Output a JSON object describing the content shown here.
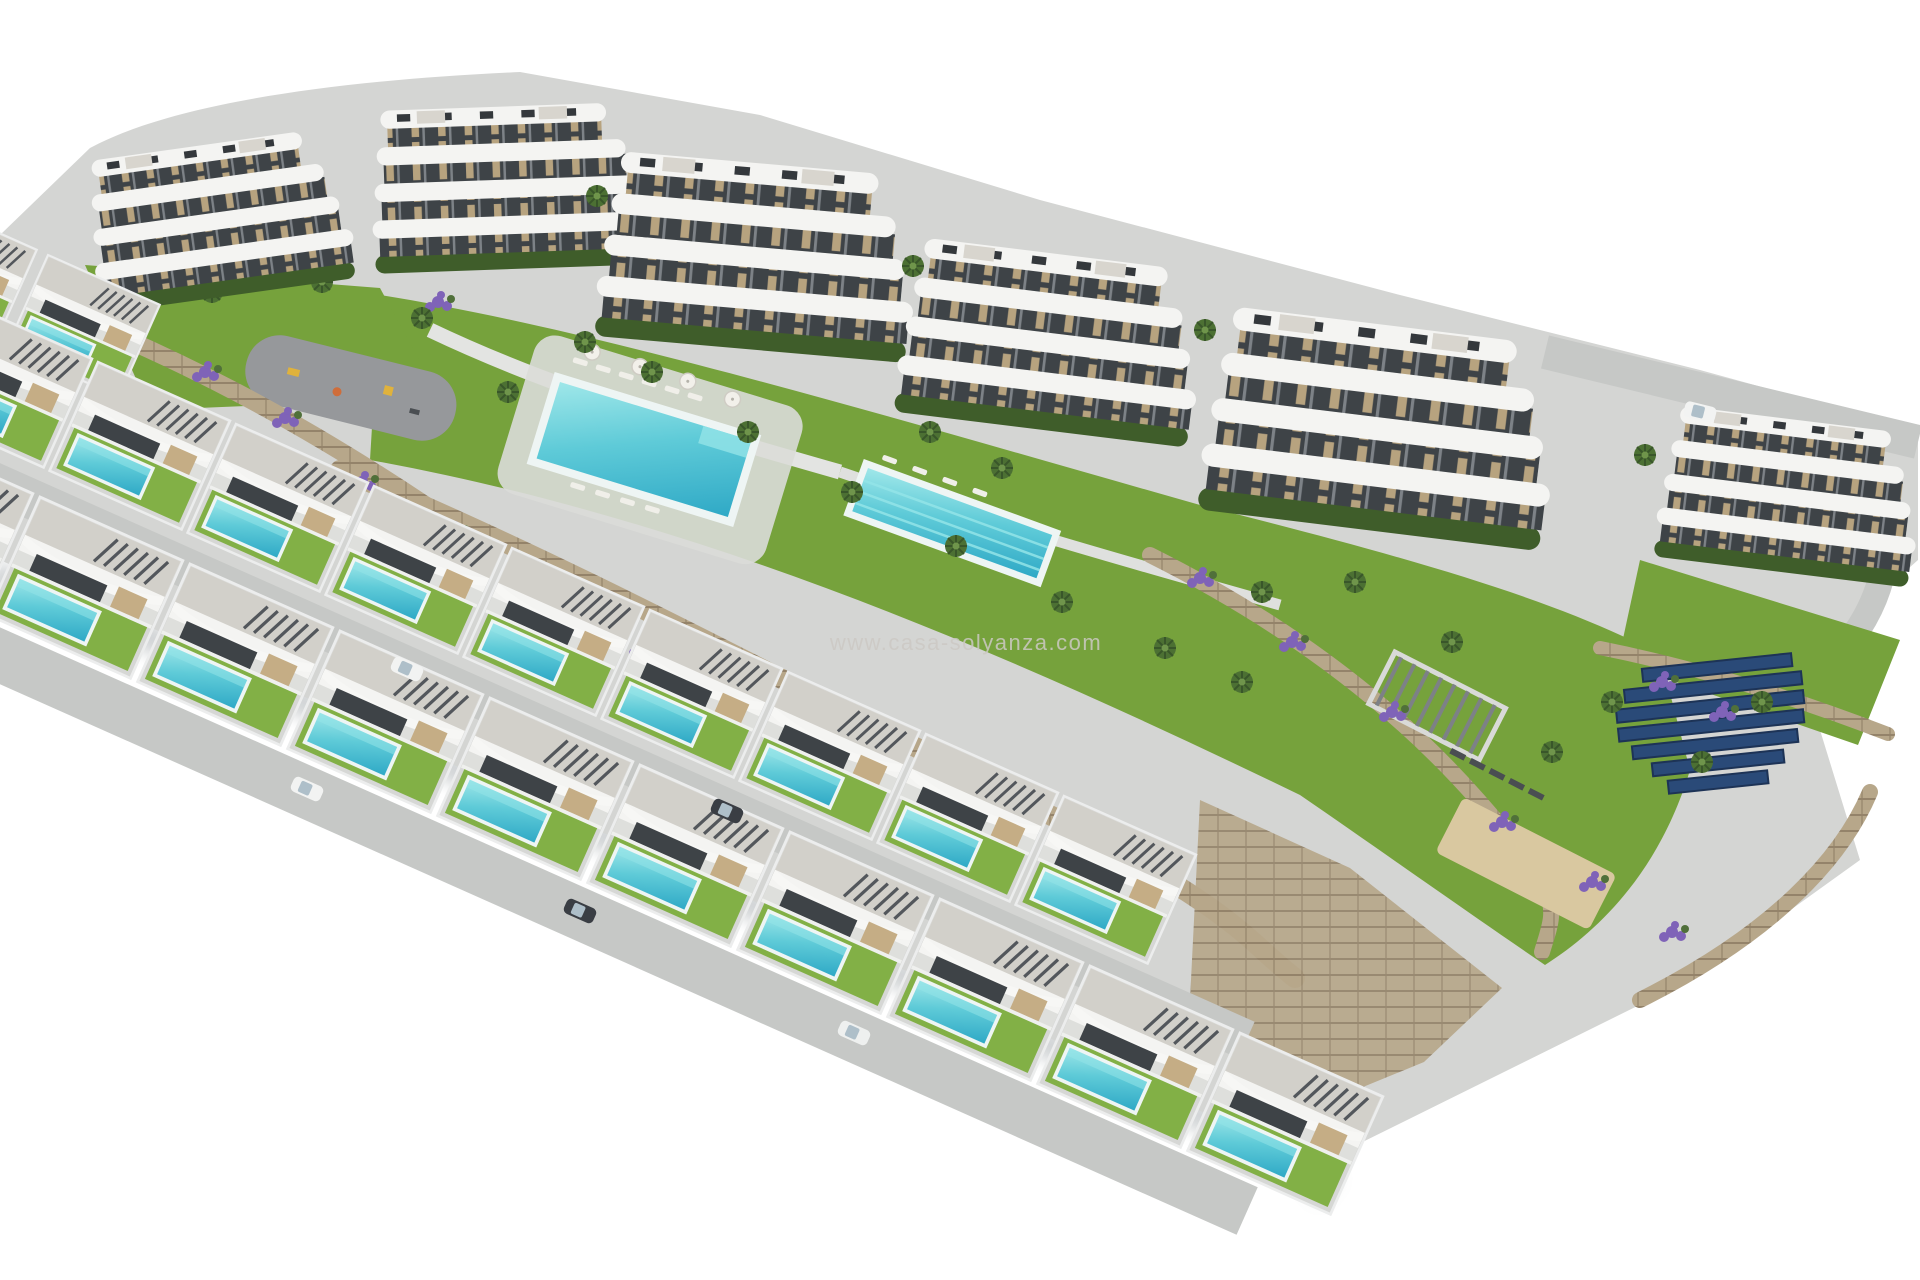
{
  "watermark": {
    "text": "www.casa-solyanza.com"
  },
  "scene": {
    "type": "aerial-architectural-render",
    "description": "Aerial 3D render of a hillside residential development on a white background: a curved row of white wavy-balcony apartment blocks at the top, two staggered rows of detached villas with private pools below, communal gardens with a large swimming pool and a lap pool, playground, pergola lounge, petanque court, lavender beds, palm trees, stone retaining walls and a solar panel field at the right.",
    "apartment_block_count": 6,
    "villa_count": 21,
    "communal_pool_count": 2,
    "private_pools": "one per villa",
    "features": [
      "curved white apartment blocks with terraces",
      "detached villas with private pools",
      "communal swimming pool with sun loungers and parasols",
      "communal lap pool",
      "children's playground",
      "pergola lounge",
      "petanque court",
      "solar panel field",
      "lavender plantings",
      "palm trees",
      "stone retaining walls",
      "access roads with parked cars"
    ]
  },
  "palette": {
    "background": "#ffffff",
    "concrete": "#d4d5d3",
    "road": "#c6c8c6",
    "facade": "#f4f4f2",
    "facade-shadow": "#dedfdc",
    "roof": "#d2d0ca",
    "window": "#3e4347",
    "tan": "#c5ad85",
    "hedge": "#3f5d2a",
    "lawn": "#76a23c",
    "lawn-light": "#82b046",
    "palm": "#4c7033",
    "pool-deep": "#35b5cc",
    "pool-light": "#93e4e7",
    "lavender": "#7f63b8",
    "stone": "#b7a78a",
    "stone-dark": "#918065",
    "sand": "#d9c8a0",
    "solar": "#2a4a78",
    "solar-edge": "#1d3356",
    "asphalt": "#96989b",
    "shadow": "#8f969a",
    "watermark": "#ccc9c4"
  }
}
